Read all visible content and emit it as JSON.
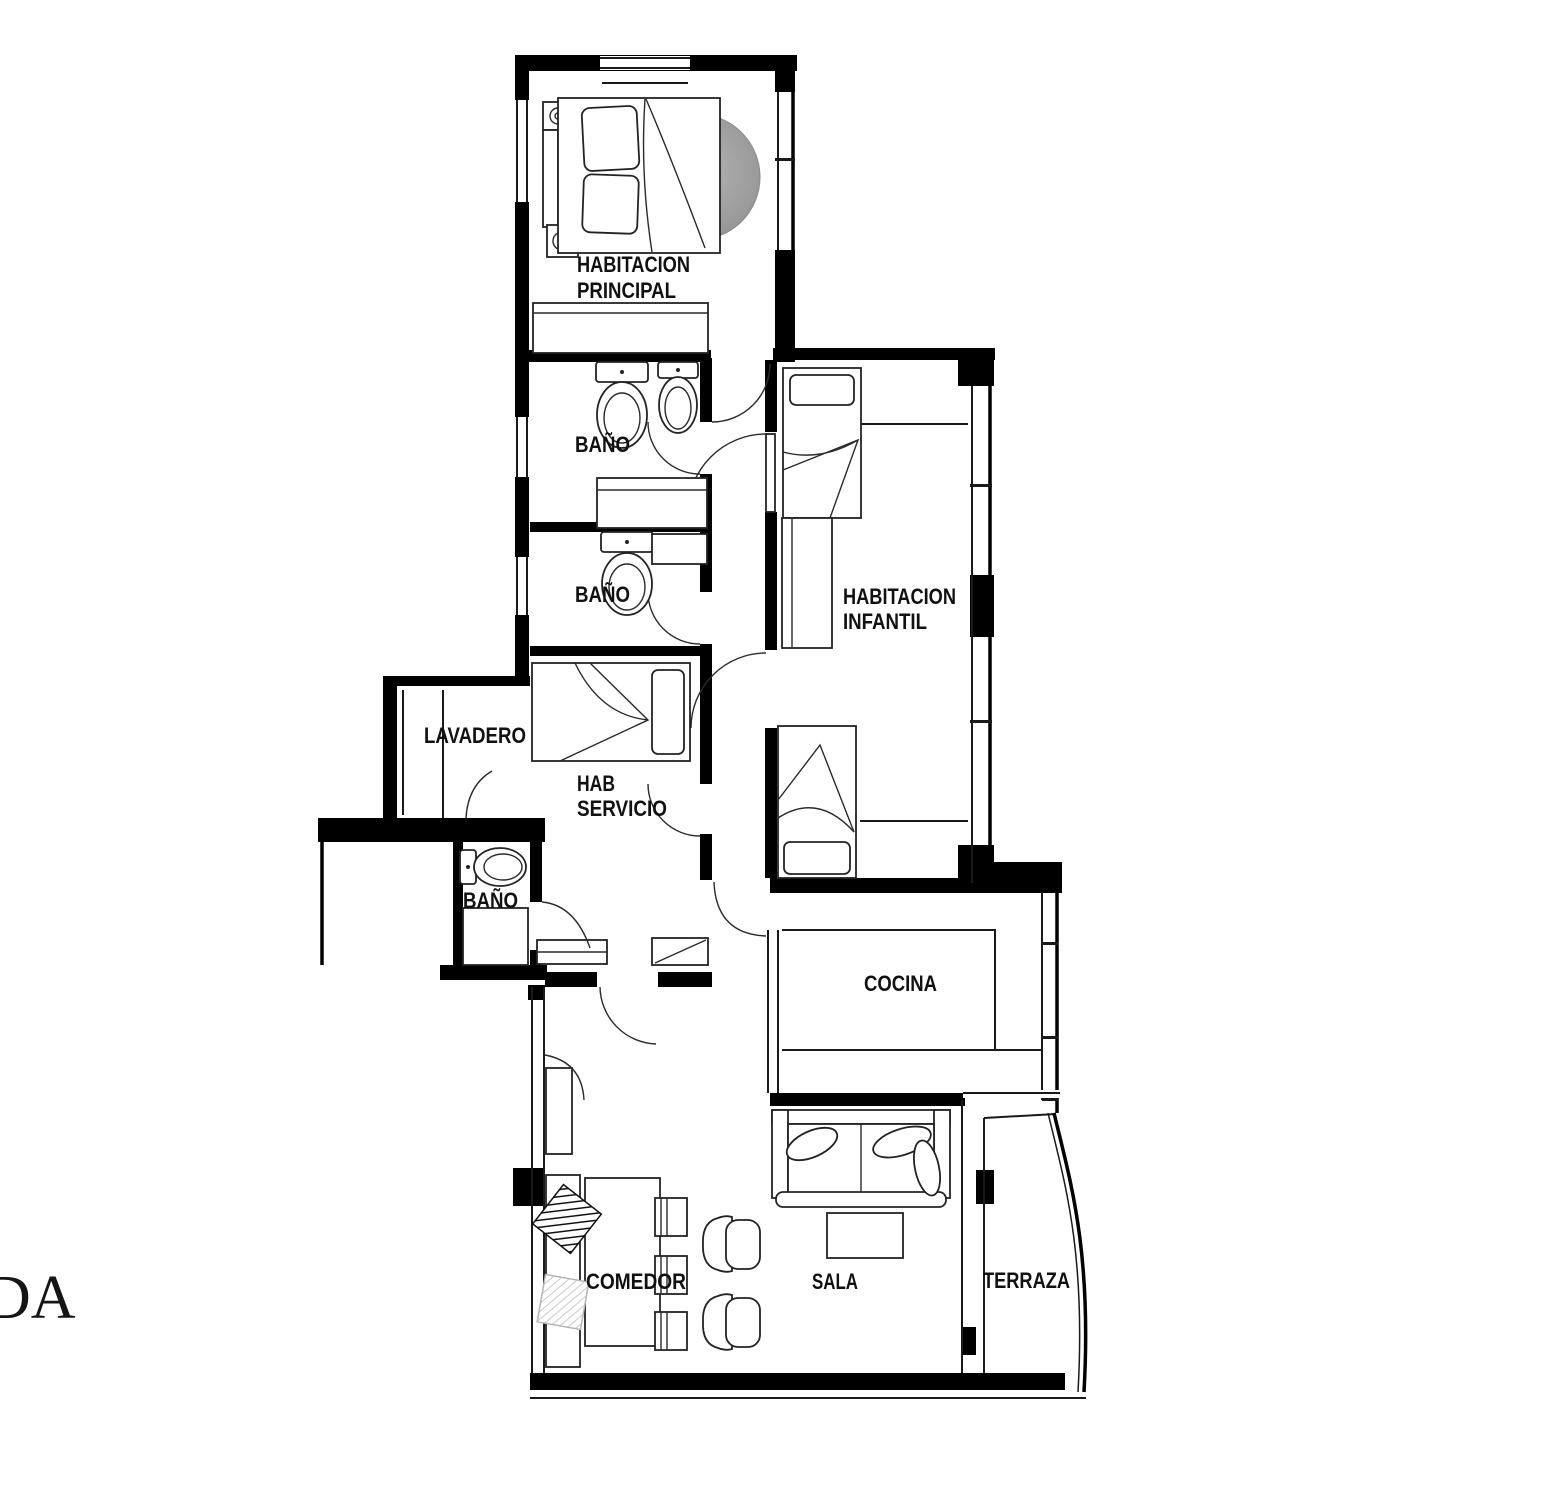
{
  "page": {
    "width": 1558,
    "height": 1500,
    "background": "#ffffff"
  },
  "plan": {
    "wall_color": "#000000",
    "line_color": "#1a1a1a",
    "label_color": "#111111",
    "rug_color": "#a8a8a8",
    "corner_text_fragment": "DA",
    "rooms": [
      {
        "id": "habitacion-principal",
        "label_lines": [
          "HABITACION",
          "PRINCIPAL"
        ]
      },
      {
        "id": "bano-principal",
        "label_lines": [
          "BAÑO"
        ]
      },
      {
        "id": "bano-secundario",
        "label_lines": [
          "BAÑO"
        ]
      },
      {
        "id": "habitacion-infantil",
        "label_lines": [
          "HABITACION",
          "INFANTIL"
        ]
      },
      {
        "id": "lavadero",
        "label_lines": [
          "LAVADERO"
        ]
      },
      {
        "id": "hab-servicio",
        "label_lines": [
          "HAB",
          "SERVICIO"
        ]
      },
      {
        "id": "bano-servicio",
        "label_lines": [
          "BAÑO"
        ]
      },
      {
        "id": "cocina",
        "label_lines": [
          "COCINA"
        ]
      },
      {
        "id": "comedor",
        "label_lines": [
          "COMEDOR"
        ]
      },
      {
        "id": "sala",
        "label_lines": [
          "SALA"
        ]
      },
      {
        "id": "terraza",
        "label_lines": [
          "TERRAZA"
        ]
      }
    ],
    "furniture_icons": [
      "double-bed-icon",
      "round-rug-icon",
      "nightstand-icon",
      "wardrobe-icon",
      "toilet-icon",
      "bidet-icon",
      "vanity-counter-icon",
      "single-bed-icon",
      "closet-icon",
      "kitchen-counter-icon",
      "sofa-icon",
      "coffee-table-icon",
      "armchair-icon",
      "dining-table-icon",
      "dining-chair-icon",
      "cushion-icon"
    ]
  }
}
